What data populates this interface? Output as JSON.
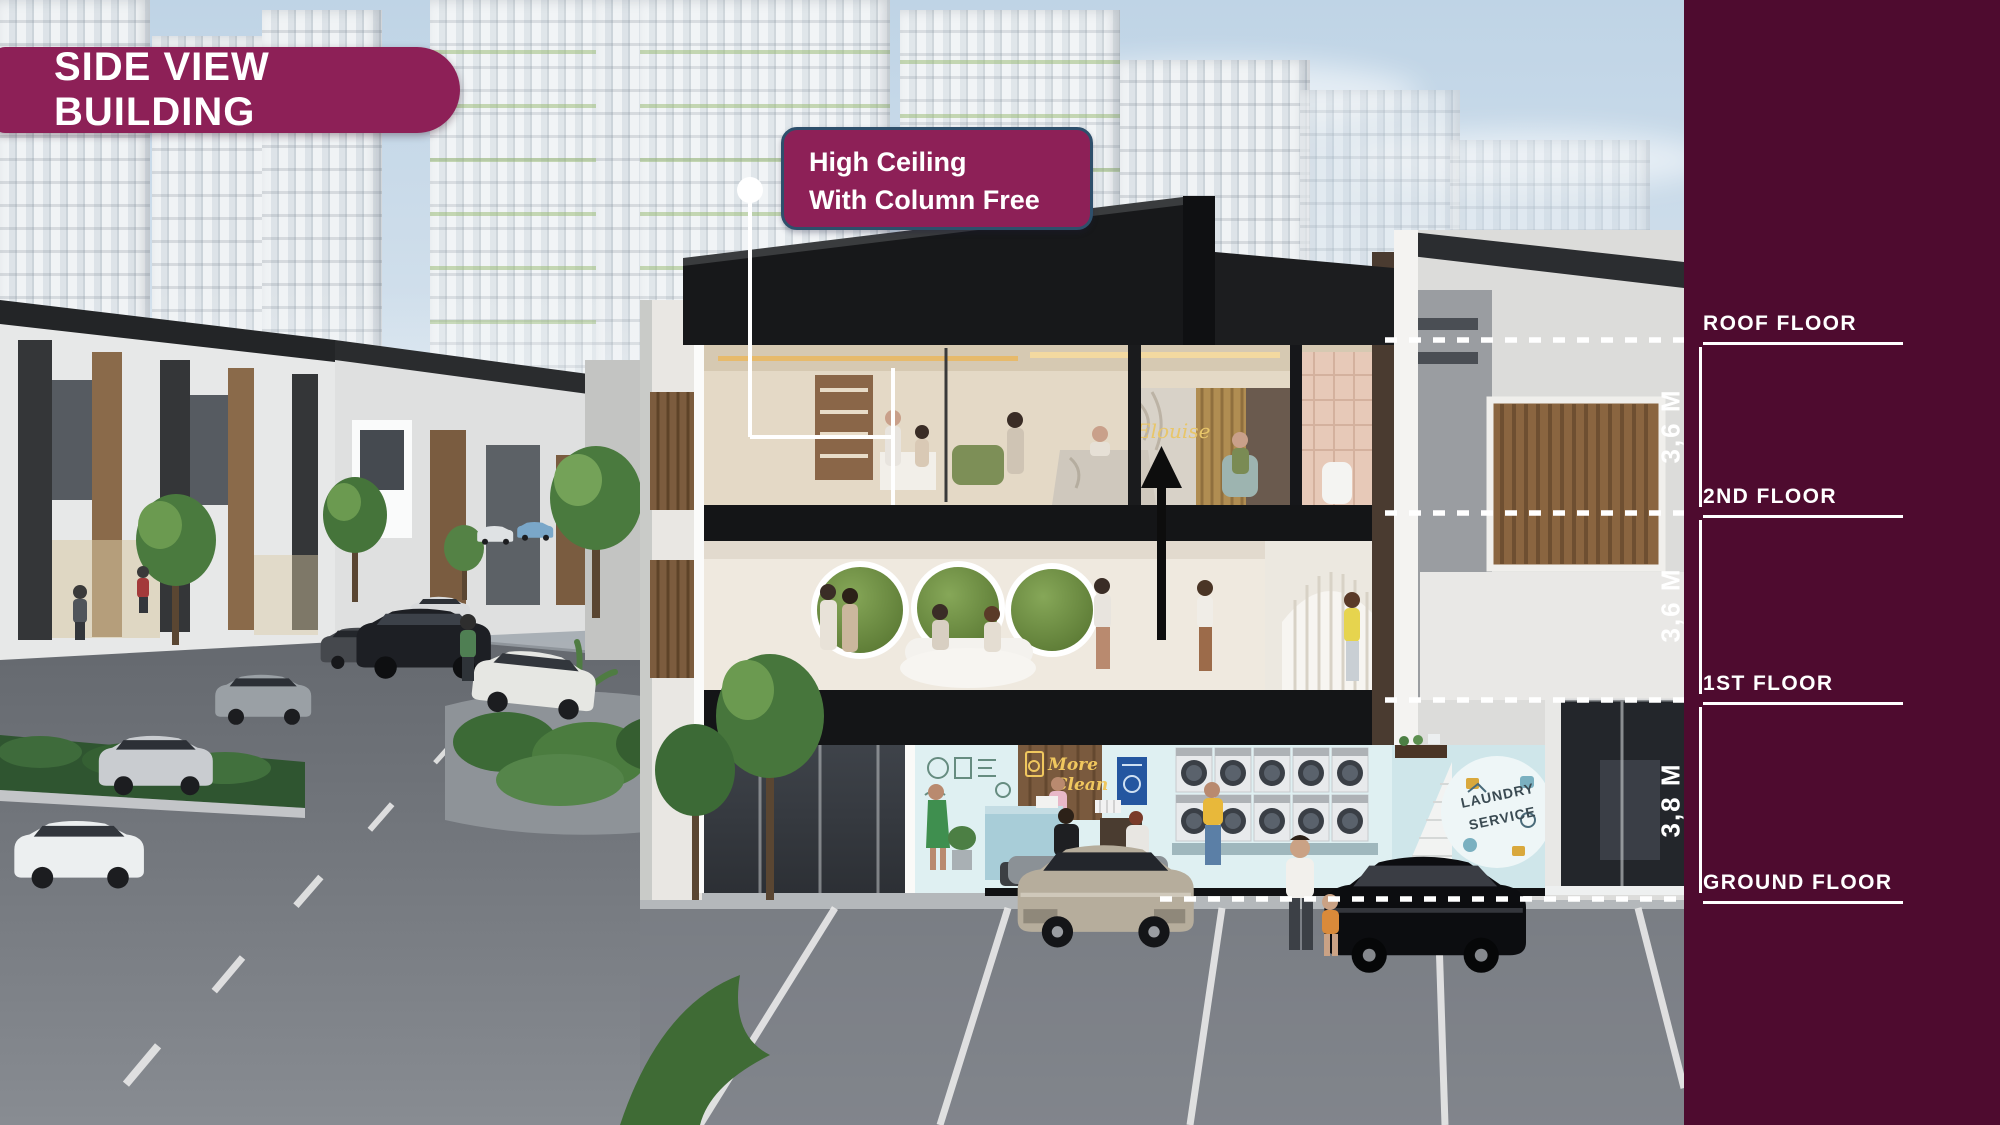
{
  "badge": {
    "title": "SIDE VIEW BUILDING"
  },
  "callout": {
    "line1": "High Ceiling",
    "line2": "With Column Free"
  },
  "floors": [
    {
      "id": "roof",
      "label": "ROOF FLOOR"
    },
    {
      "id": "2nd",
      "label": "2ND FLOOR"
    },
    {
      "id": "1st",
      "label": "1ST FLOOR"
    },
    {
      "id": "ground",
      "label": "GROUND FLOOR"
    }
  ],
  "dimensions": [
    {
      "between": "roof-to-2nd",
      "value": "3,6 M"
    },
    {
      "between": "2nd-to-1st",
      "value": "3,6 M"
    },
    {
      "between": "1st-to-ground",
      "value": "3,8 M"
    }
  ],
  "scene_signage": {
    "salon_sign": "Elouise",
    "laundry_wall_sign_line1": "More",
    "laundry_wall_sign_line2": "Clean",
    "laundry_mural_line1": "LAUNDRY",
    "laundry_mural_line2": "SERVICE"
  },
  "colors": {
    "brand_maroon": "#8D2057",
    "band_maroon": "#4E0B2F",
    "callout_border": "#2E4F6B",
    "annotation_white": "#FFFFFF"
  }
}
